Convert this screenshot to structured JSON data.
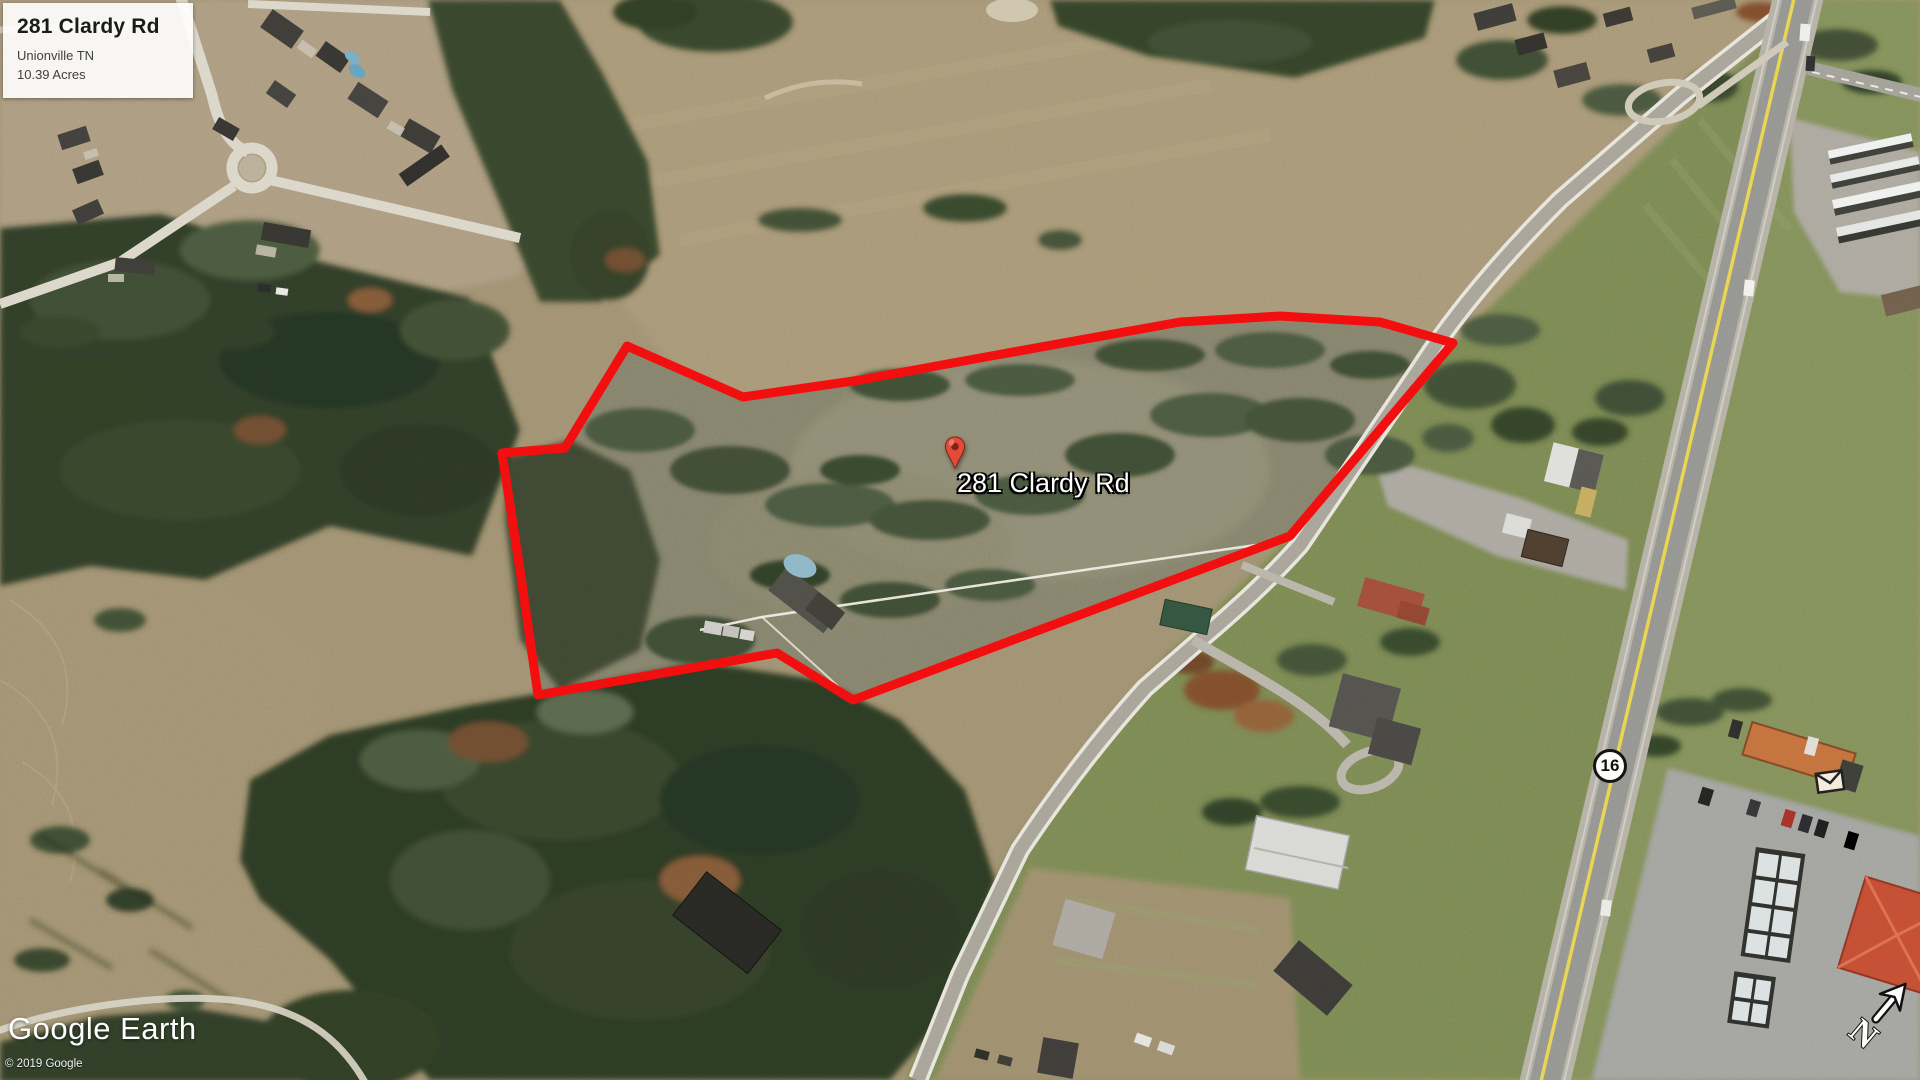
{
  "app": {
    "logo": "Google Earth",
    "copyright": "© 2019 Google"
  },
  "info_box": {
    "title": "281 Clardy Rd",
    "subtitle": "Unionville TN",
    "acreage": "10.39 Acres"
  },
  "placemark": {
    "label": "281 Clardy Rd"
  },
  "map": {
    "highway_shield": "16",
    "compass_letter": "N"
  },
  "colors": {
    "boundary": "#f20d0d",
    "pin": "#e24b3a",
    "pin_hole": "#7c241a"
  }
}
